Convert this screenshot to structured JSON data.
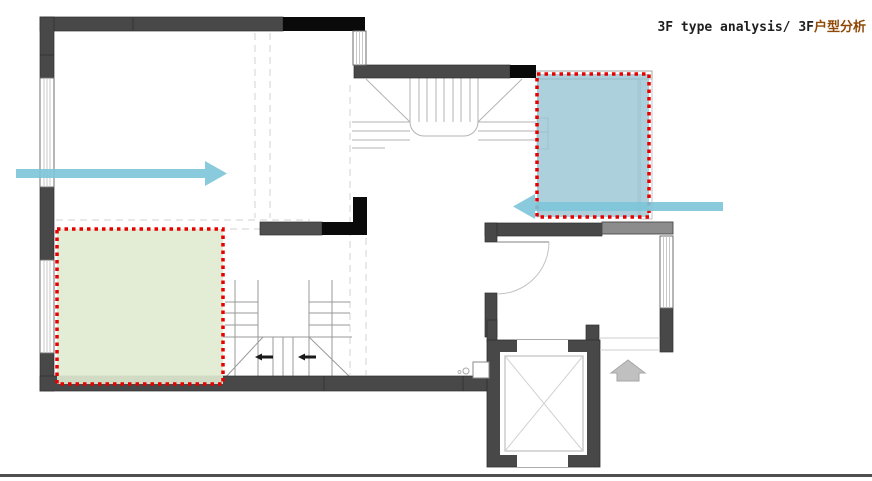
{
  "header": {
    "title_en": "3F type analysis/ 3F",
    "title_zh": "户型分析",
    "title_en_color": "#1f1f1f",
    "title_zh_color": "#8f4a08"
  },
  "floor_plan": {
    "colors": {
      "wall_dark": "#484848",
      "wall_black": "#0a0a0a",
      "wall_medium": "#8c8c8c",
      "stair_line": "#b3b3b3",
      "dashed_guide": "#dadada"
    }
  },
  "annotations": {
    "highlight_border_color": "#e60000",
    "regions": [
      {
        "id": "blue-room-highlight",
        "fill": "rgba(140,190,206,0.72)"
      },
      {
        "id": "green-room-highlight",
        "fill": "rgba(224,234,207,0.9)"
      }
    ],
    "arrows": [
      {
        "id": "flow-arrow-right",
        "direction": "right",
        "color": "#7cc5d8"
      },
      {
        "id": "flow-arrow-left",
        "direction": "left",
        "color": "#7cc5d8"
      }
    ],
    "up_arrow_color": "#c0c0c0"
  },
  "footer": {
    "divider_color": "#4f4f4f"
  }
}
